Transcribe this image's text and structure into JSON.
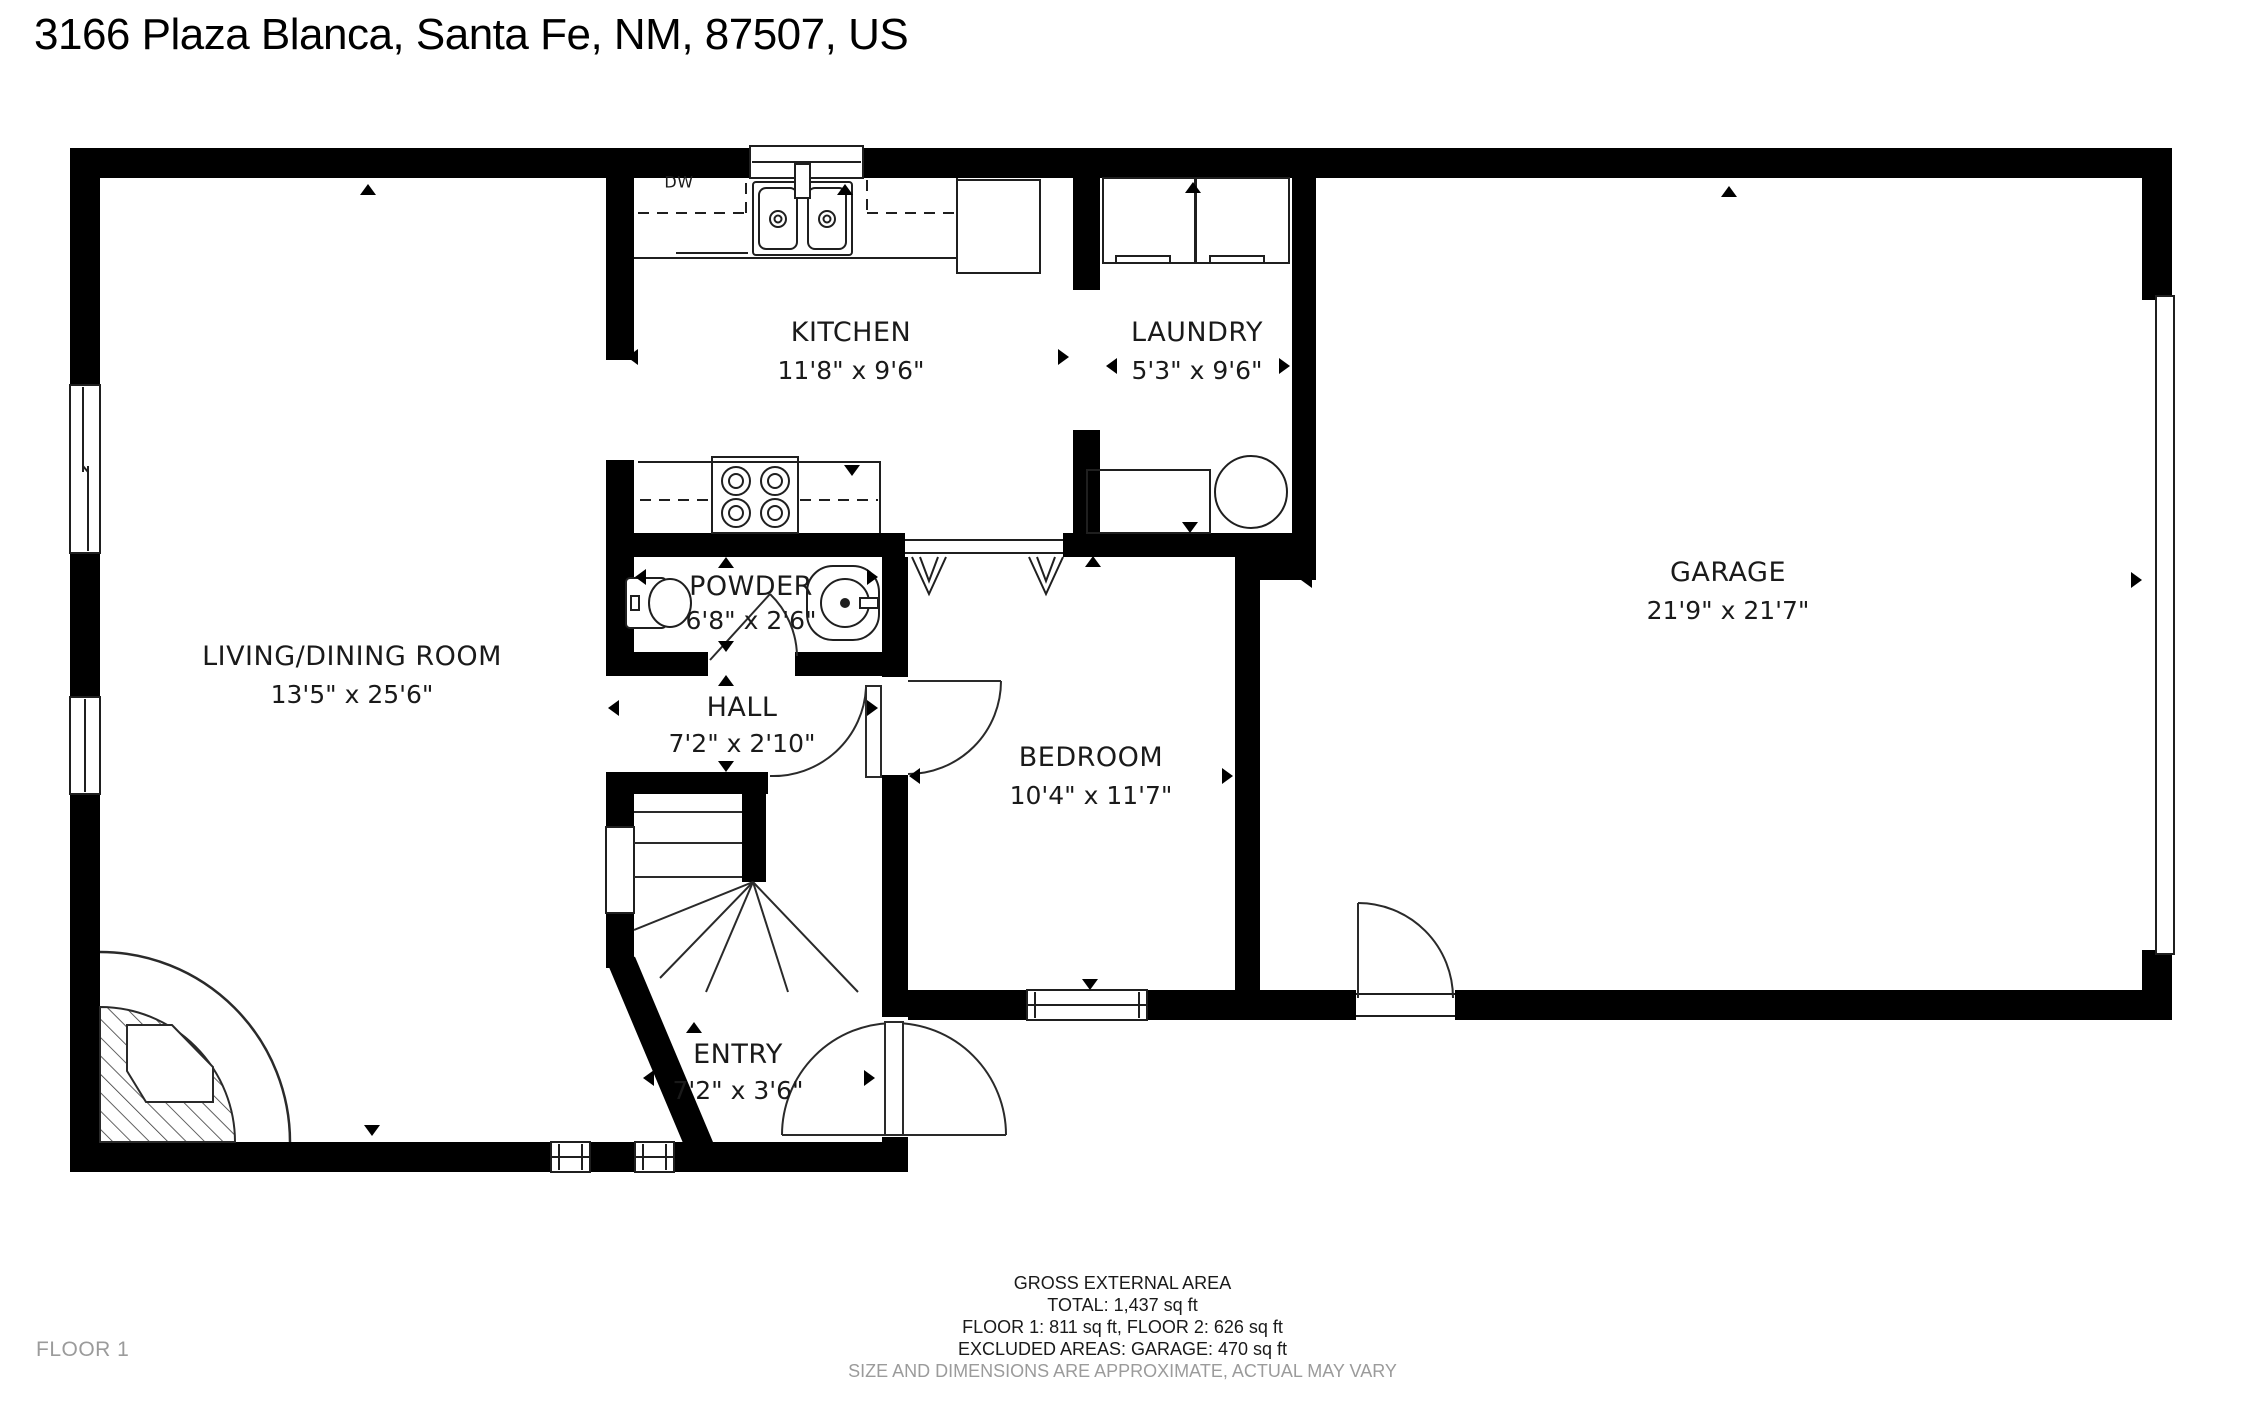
{
  "title": "3166 Plaza Blanca, Santa Fe, NM, 87507, US",
  "floor_label": "FLOOR 1",
  "rooms": {
    "living": {
      "name": "LIVING/DINING ROOM",
      "dims": "13'5\" x 25'6\""
    },
    "kitchen": {
      "name": "KITCHEN",
      "dims": "11'8\" x 9'6\""
    },
    "laundry": {
      "name": "LAUNDRY",
      "dims": "5'3\" x 9'6\""
    },
    "garage": {
      "name": "GARAGE",
      "dims": "21'9\" x 21'7\""
    },
    "powder": {
      "name": "POWDER",
      "dims": "6'8\" x 2'6\""
    },
    "hall": {
      "name": "HALL",
      "dims": "7'2\" x 2'10\""
    },
    "bedroom": {
      "name": "BEDROOM",
      "dims": "10'4\" x 11'7\""
    },
    "entry": {
      "name": "ENTRY",
      "dims": "7'2\" x 3'6\""
    }
  },
  "labels": {
    "dishwasher": "DW"
  },
  "footer": {
    "line1": "GROSS EXTERNAL AREA",
    "line2": "TOTAL: 1,437 sq ft",
    "line3": "FLOOR 1: 811 sq ft, FLOOR 2: 626 sq ft",
    "line4": "EXCLUDED AREAS: GARAGE: 470 sq ft",
    "disclaimer": "SIZE AND DIMENSIONS ARE APPROXIMATE, ACTUAL MAY VARY"
  },
  "colors": {
    "wall": "#000000",
    "text": "#1a1a1a",
    "muted": "#9b9b9b",
    "background": "#ffffff"
  }
}
